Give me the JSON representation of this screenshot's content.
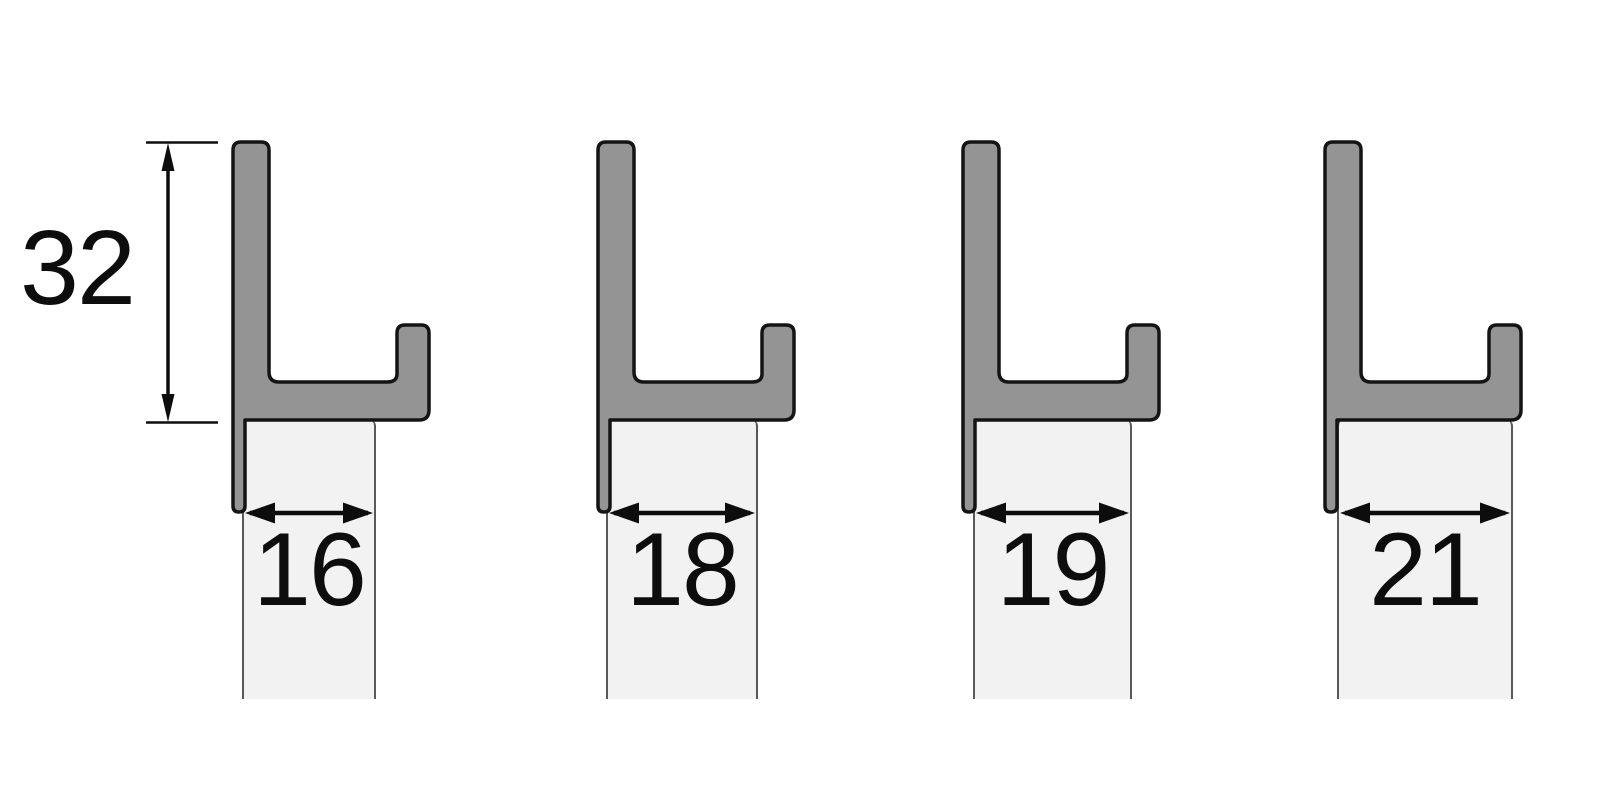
{
  "diagram": {
    "title": "edge-profile-cross-sections",
    "height_dimension": {
      "label": "32"
    },
    "profiles": [
      {
        "width_label": "16"
      },
      {
        "width_label": "18"
      },
      {
        "width_label": "19"
      },
      {
        "width_label": "21"
      }
    ],
    "colors": {
      "profile_fill": "#949494",
      "profile_outline": "#141414",
      "panel_fill": "#f2f2f2",
      "panel_border": "#595959",
      "dimension_color": "#0d0d0d",
      "background": "#ffffff"
    }
  }
}
